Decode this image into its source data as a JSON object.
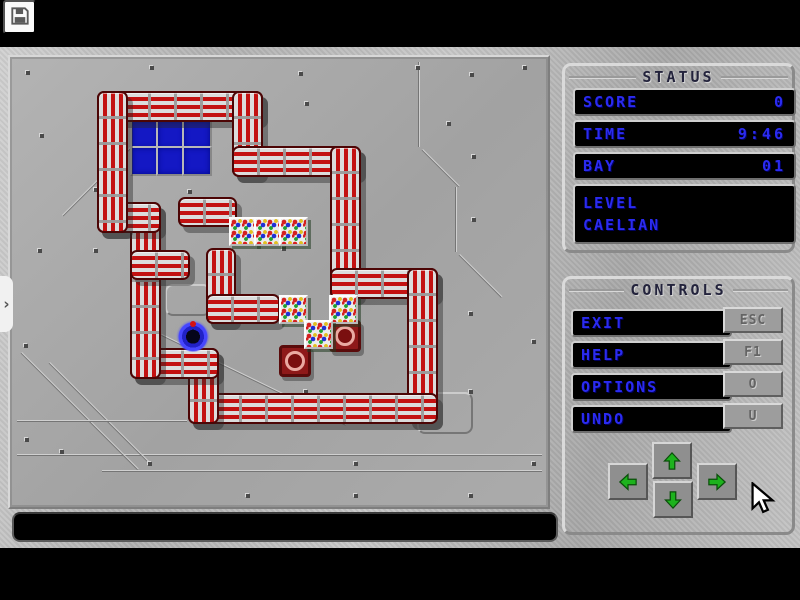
{
  "toolbar": {
    "save_icon": "floppy-disk"
  },
  "side_tab": {
    "chevron": "›"
  },
  "status_panel": {
    "title": "STATUS",
    "rows": [
      {
        "label": "SCORE",
        "value": "0"
      },
      {
        "label": "TIME",
        "value": "9:46"
      },
      {
        "label": "BAY",
        "value": "01"
      }
    ],
    "level_label": "LEVEL",
    "level_value": "CAELIAN"
  },
  "controls_panel": {
    "title": "CONTROLS",
    "buttons": [
      {
        "label": "EXIT",
        "key": "ESC"
      },
      {
        "label": "HELP",
        "key": "F1"
      },
      {
        "label": "OPTIONS",
        "key": "O"
      },
      {
        "label": "UNDO",
        "key": "U"
      }
    ],
    "arrows": [
      "up",
      "down",
      "left",
      "right"
    ]
  },
  "message_bar": {
    "text": ""
  },
  "colors": {
    "text_blue": "#2b2bf0",
    "pipe_red": "#c31111",
    "floor_gray": "#a8a8a8",
    "target_red": "#8e1919",
    "player_blue": "#4646ff",
    "arrow_green": "#1db31d"
  },
  "board": {
    "walls": [
      [
        87,
        34,
        162,
        27,
        "h"
      ],
      [
        222,
        34,
        27,
        82,
        "v"
      ],
      [
        222,
        89,
        125,
        27,
        "h"
      ],
      [
        320,
        89,
        27,
        149,
        "v"
      ],
      [
        320,
        211,
        104,
        27,
        "h"
      ],
      [
        397,
        211,
        27,
        152,
        "v"
      ],
      [
        178,
        336,
        246,
        27,
        "h"
      ],
      [
        178,
        291,
        27,
        72,
        "v"
      ],
      [
        120,
        291,
        85,
        27,
        "h"
      ],
      [
        120,
        145,
        27,
        173,
        "v"
      ],
      [
        87,
        145,
        60,
        27,
        "h"
      ],
      [
        87,
        34,
        27,
        138,
        "v"
      ],
      [
        168,
        140,
        55,
        26,
        "h"
      ],
      [
        120,
        193,
        56,
        26,
        "h"
      ],
      [
        196,
        191,
        26,
        72,
        "v"
      ],
      [
        196,
        237,
        70,
        26,
        "h"
      ]
    ],
    "bay": {
      "x": 120,
      "y": 63,
      "cols": 3,
      "rows": 2,
      "cell": 26
    },
    "crates": [
      [
        219,
        160
      ],
      [
        244,
        160
      ],
      [
        269,
        160
      ],
      [
        269,
        238
      ],
      [
        319,
        238
      ],
      [
        294,
        263
      ]
    ],
    "targets": [
      [
        319,
        263
      ],
      [
        269,
        288
      ]
    ],
    "player": {
      "x": 166,
      "y": 261,
      "size": 34
    },
    "screws": [
      [
        16,
        14
      ],
      [
        140,
        9
      ],
      [
        289,
        15
      ],
      [
        406,
        9
      ],
      [
        460,
        16
      ],
      [
        513,
        9
      ],
      [
        30,
        77
      ],
      [
        84,
        131
      ],
      [
        178,
        133
      ],
      [
        254,
        97
      ],
      [
        295,
        45
      ],
      [
        437,
        65
      ],
      [
        462,
        98
      ],
      [
        28,
        192
      ],
      [
        84,
        192
      ],
      [
        462,
        161
      ],
      [
        272,
        190
      ],
      [
        344,
        190
      ],
      [
        14,
        287
      ],
      [
        404,
        283
      ],
      [
        459,
        255
      ],
      [
        522,
        283
      ],
      [
        294,
        333
      ],
      [
        404,
        362
      ],
      [
        459,
        333
      ],
      [
        138,
        405
      ],
      [
        50,
        393
      ],
      [
        236,
        437
      ],
      [
        344,
        437
      ],
      [
        459,
        437
      ],
      [
        522,
        405
      ],
      [
        344,
        405
      ],
      [
        15,
        381
      ]
    ],
    "lines": [
      [
        52,
        158,
        100,
        -45
      ],
      [
        410,
        5,
        85,
        90
      ],
      [
        413,
        92,
        52,
        45
      ],
      [
        447,
        130,
        65,
        90
      ],
      [
        450,
        197,
        60,
        45
      ],
      [
        7,
        397,
        525,
        0
      ],
      [
        92,
        413,
        440,
        0
      ],
      [
        152,
        277,
        205,
        26
      ],
      [
        12,
        295,
        165,
        45
      ],
      [
        40,
        305,
        140,
        45
      ],
      [
        7,
        363,
        170,
        0
      ]
    ],
    "panels": [
      [
        407,
        335,
        52,
        38
      ],
      [
        155,
        227,
        42,
        28
      ]
    ]
  }
}
